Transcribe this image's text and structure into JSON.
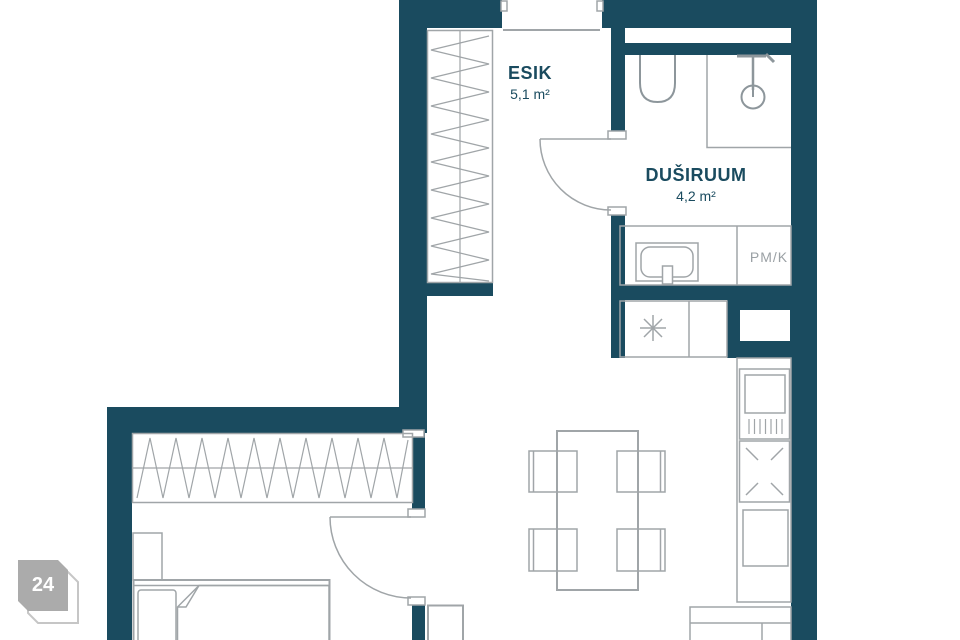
{
  "plan": {
    "unit_badge": "24",
    "rooms": [
      {
        "id": "esik",
        "name": "ESIK",
        "area": "5,1 m²"
      },
      {
        "id": "dushiruum",
        "name": "DUŠIRUUM",
        "area": "4,2 m²"
      }
    ],
    "labels": {
      "pmk": "PM/K"
    }
  },
  "colors": {
    "wall": "#1a4b5f",
    "furniture_line": "#a0a5a8",
    "fixture_line": "#8d969b",
    "label_text": "#1a4b5f",
    "label_gray": "#9aa0a4",
    "badge_fill": "#ababab",
    "badge_outline": "#c6c6c6"
  }
}
